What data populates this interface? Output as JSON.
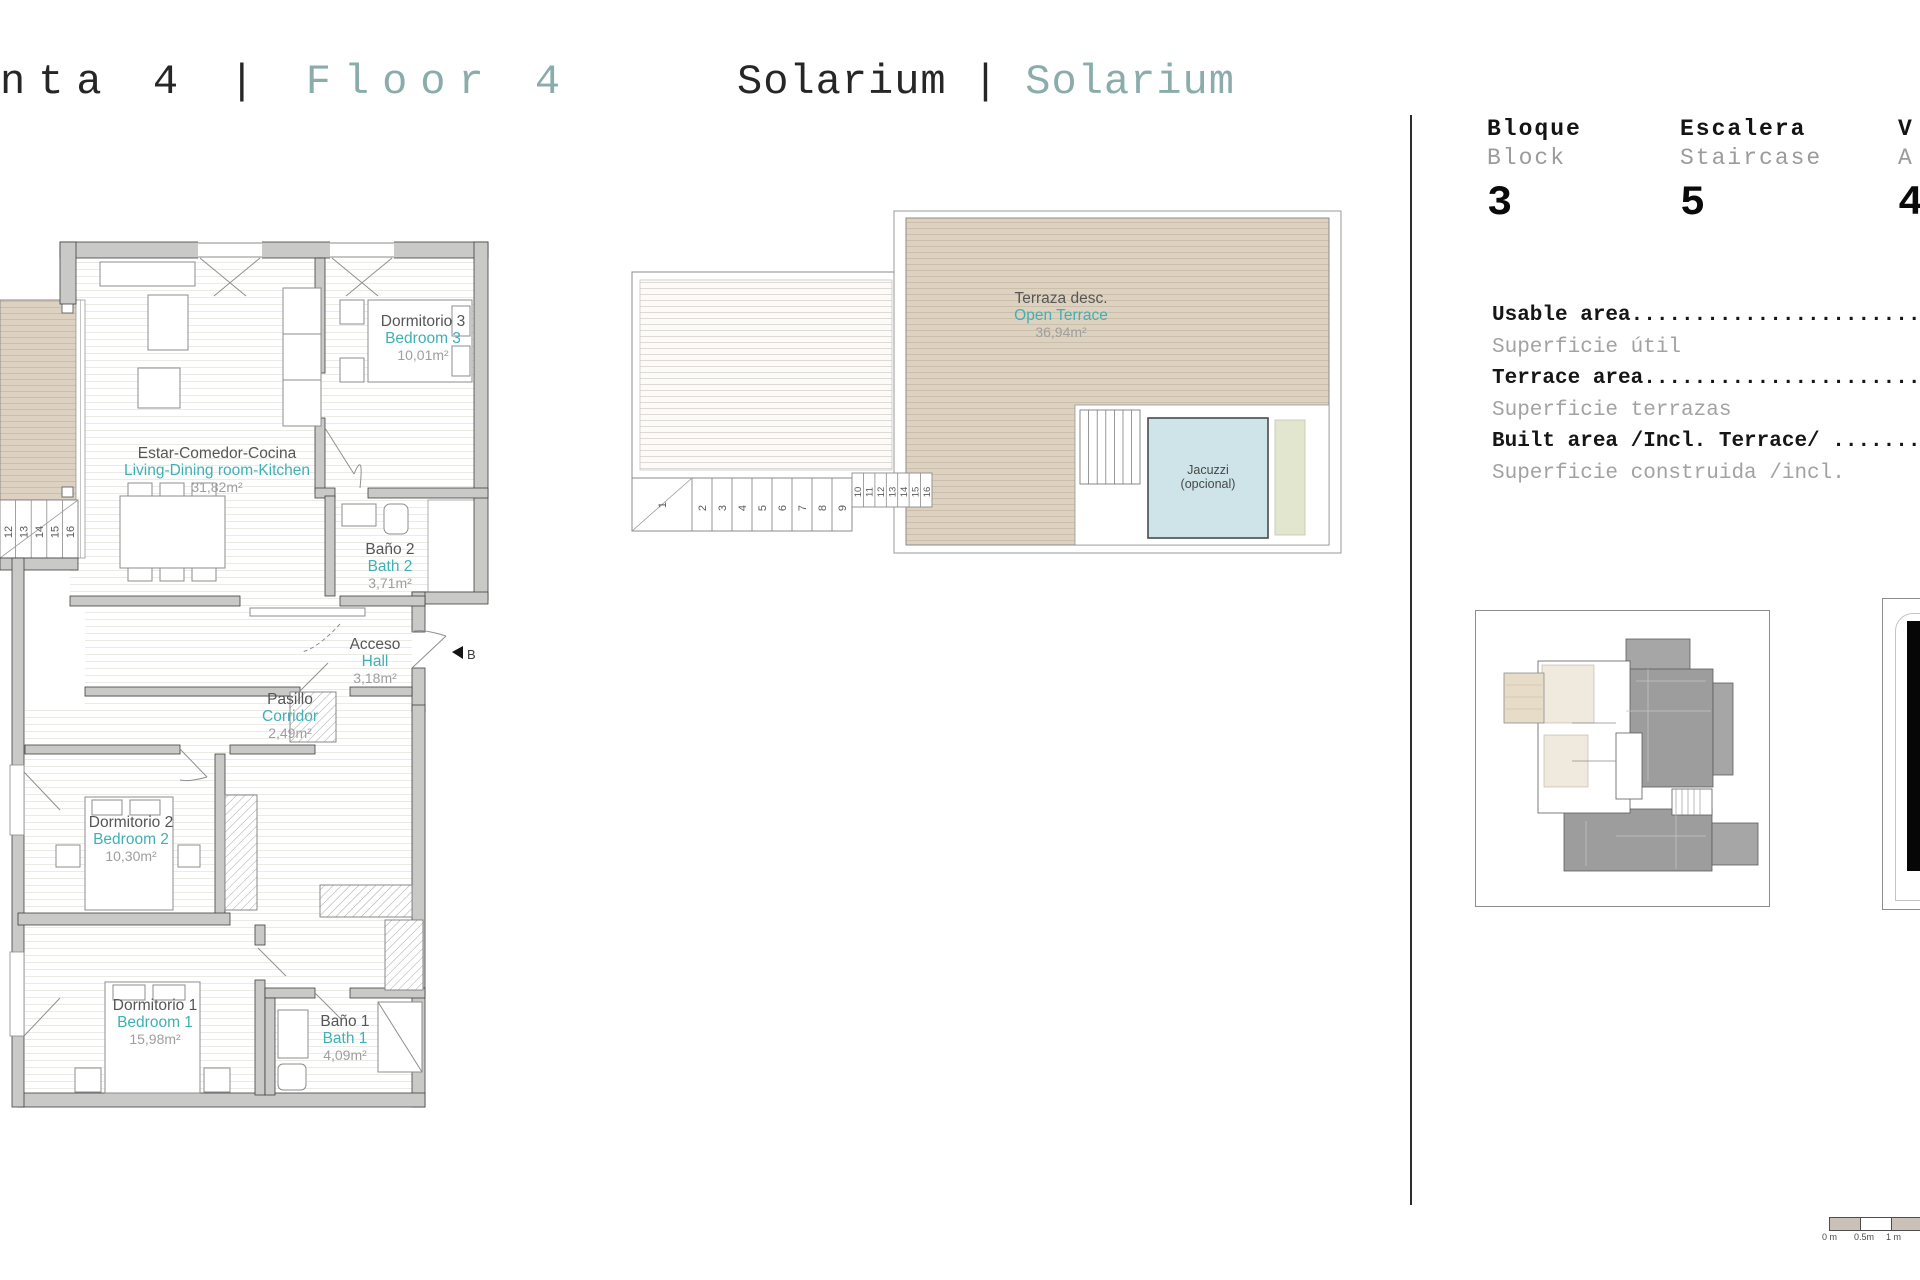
{
  "titles": {
    "left_primary": "nta 4",
    "left_separator": "|",
    "left_secondary": "Floor 4",
    "center_primary": "Solarium",
    "center_separator": "|",
    "center_secondary": "Solarium"
  },
  "header": {
    "cols": [
      {
        "es": "Bloque",
        "en": "Block",
        "value": "3"
      },
      {
        "es": "Escalera",
        "en": "Staircase",
        "value": "5"
      },
      {
        "es": "V",
        "en": "A",
        "value": "4"
      }
    ]
  },
  "areas": {
    "rows": [
      {
        "en": "Usable area..............................",
        "es": "Superficie útil"
      },
      {
        "en": "Terrace area.............................",
        "es": "Superficie terrazas"
      },
      {
        "en": "Built area /Incl. Terrace/ ..............",
        "es": "Superficie construida /incl."
      }
    ]
  },
  "plan": {
    "rooms": [
      {
        "es": "Dormitorio 3",
        "en": "Bedroom 3",
        "area": "10,01m²"
      },
      {
        "es": "Estar-Comedor-Cocina",
        "en": "Living-Dining room-Kitchen",
        "area": "31,82m²"
      },
      {
        "es": "Baño 2",
        "en": "Bath 2",
        "area": "3,71m²"
      },
      {
        "es": "Acceso",
        "en": "Hall",
        "area": "3,18m²"
      },
      {
        "es": "Pasillo",
        "en": "Corridor",
        "area": "2,49m²"
      },
      {
        "es": "Dormitorio 2",
        "en": "Bedroom 2",
        "area": "10,30m²"
      },
      {
        "es": "Dormitorio 1",
        "en": "Bedroom 1",
        "area": "15,98m²"
      },
      {
        "es": "Baño 1",
        "en": "Bath 1",
        "area": "4,09m²"
      }
    ],
    "entry_marker": "B",
    "stair_numbers": [
      "12",
      "13",
      "14",
      "15",
      "16"
    ]
  },
  "solarium": {
    "room": {
      "es": "Terraza desc.",
      "en": "Open Terrace",
      "area": "36,94m²"
    },
    "jacuzzi": {
      "line1": "Jacuzzi",
      "line2": "(opcional)"
    },
    "stair_numbers": [
      "1",
      "2",
      "3",
      "4",
      "5",
      "6",
      "7",
      "8",
      "9",
      "10",
      "11",
      "12",
      "13",
      "14",
      "15",
      "16"
    ]
  },
  "scalebar": {
    "labels": [
      "0 m",
      "0.5m",
      "1 m"
    ]
  },
  "colors": {
    "title_teal": "#8aacab",
    "plan_teal": "#3fb0b4",
    "deck_beige": "#ddd2c1",
    "jacuzzi_blue": "#cfe4e9",
    "wall_gray": "#c9c9c7",
    "text_dark": "#161616",
    "text_gray": "#9b9b9b"
  }
}
